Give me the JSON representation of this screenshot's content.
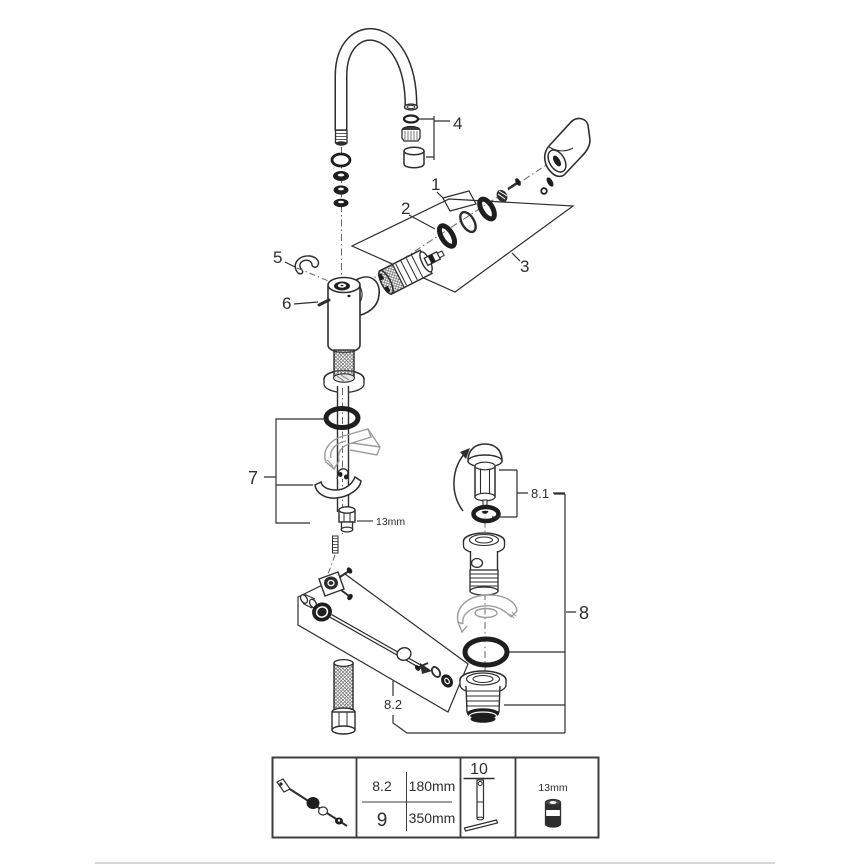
{
  "diagram": {
    "kind": "exploded-parts-diagram",
    "subject": "single-lever basin mixer faucet with pop-up waste set",
    "colors": {
      "line": "#2e2e2e",
      "translucent": "#9c9c9c",
      "background": "#ffffff"
    },
    "callouts": {
      "part1": "1",
      "part2": "2",
      "part3": "3",
      "part4": "4",
      "part5": "5",
      "part6": "6",
      "part7": "7",
      "part8": "8",
      "part8_1": "8.1",
      "part8_2": "8.2",
      "nut_size": "13mm"
    }
  },
  "table": {
    "rows": [
      {
        "ref": "8.2",
        "length": "180mm"
      },
      {
        "ref": "9",
        "length": "350mm"
      }
    ],
    "tool_ref": "10",
    "socket_size": "13mm"
  }
}
